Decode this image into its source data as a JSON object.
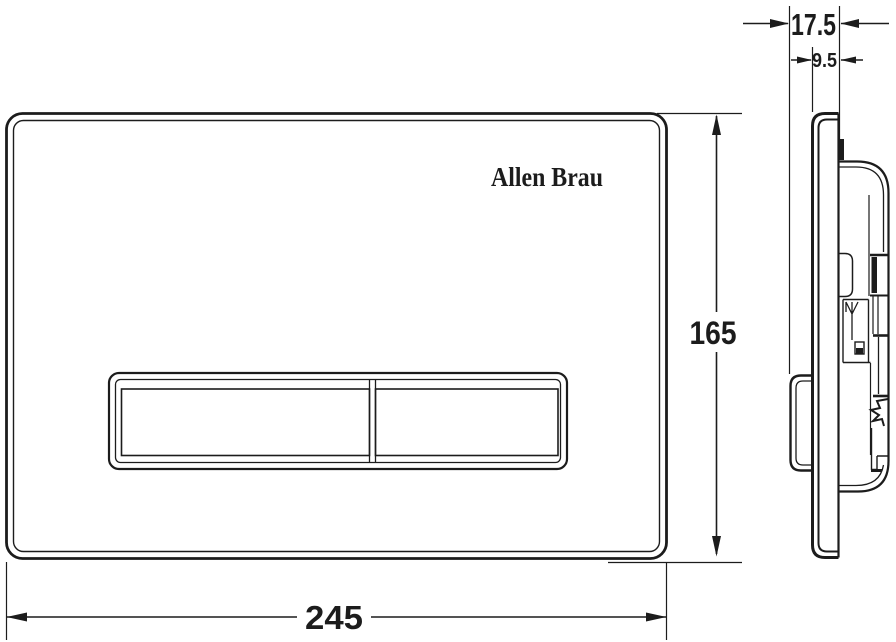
{
  "drawing": {
    "background": "#ffffff",
    "line_color": "#1c1c1c",
    "front_view": {
      "logo": "Allen Brau"
    },
    "dimensions": {
      "width": "245",
      "height": "165",
      "total_depth": "17.5",
      "plate_depth": "9.5"
    }
  }
}
